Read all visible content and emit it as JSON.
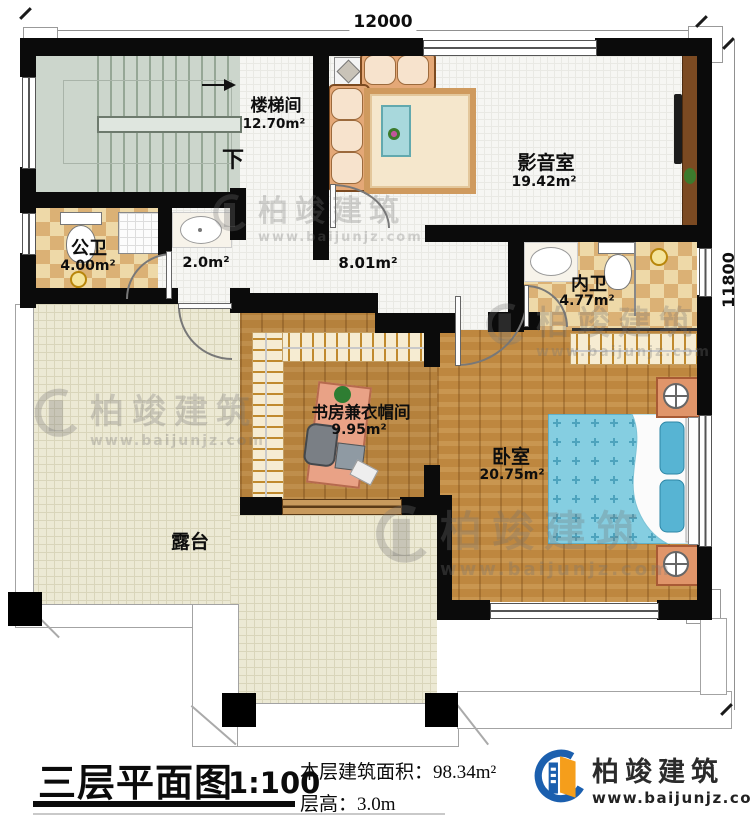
{
  "dimensions": {
    "width_label": "12000",
    "height_label": "11800"
  },
  "rooms": {
    "stairwell": {
      "name": "楼梯间",
      "area": "12.70m²",
      "direction": "下"
    },
    "media_room": {
      "name": "影音室",
      "area": "19.42m²"
    },
    "public_bathroom": {
      "name": "公卫",
      "area": "4.00m²"
    },
    "washroom": {
      "area": "2.0m²"
    },
    "hallway": {
      "area": "8.01m²"
    },
    "ensuite_bathroom": {
      "name": "内卫",
      "area": "4.77m²"
    },
    "study_cloakroom": {
      "name": "书房兼衣帽间",
      "area": "9.95m²"
    },
    "bedroom": {
      "name": "卧室",
      "area": "20.75m²"
    },
    "terrace": {
      "name": "露台"
    }
  },
  "title_block": {
    "title": "三层平面图",
    "scale": "1:100",
    "floor_area": "本层建筑面积：98.34m²",
    "floor_height": "层高：3.0m"
  },
  "brand": {
    "name": "柏竣建筑",
    "website": "www.baijunjz.com"
  }
}
